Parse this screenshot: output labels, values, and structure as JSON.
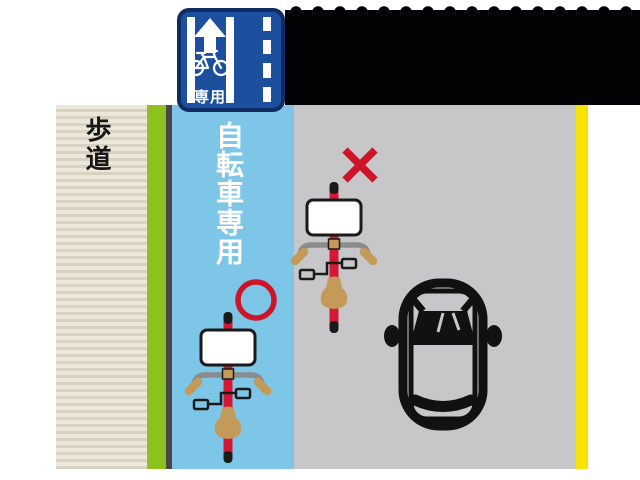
{
  "labels": {
    "sidewalk": "歩道",
    "bike_lane": "自転車専用",
    "sign_caption": "専用"
  },
  "icons": {
    "sign_arrow": "up-arrow",
    "sign_bicycle": "bicycle-outline",
    "correct_mark": "red-circle-outline",
    "wrong_mark": "red-x-mark",
    "bicycle_in_lane": "bicycle-top-view",
    "bicycle_on_road": "bicycle-top-view",
    "car": "car-top-view"
  },
  "colors": {
    "sign_blue": "#1d4f9f",
    "sign_border": "#0f2c63",
    "lane_blue": "#7ec6e7",
    "curb_green": "#8cc11f",
    "road_gray": "#c7c7c9",
    "edge_yellow": "#f6e400",
    "mark_red": "#cf1428",
    "sidewalk_beige": "#ebe7db",
    "sidewalk_stripe": "#d9d2c1",
    "saddle_tan": "#c39a58",
    "handlebar_gray": "#8b8b8b"
  }
}
